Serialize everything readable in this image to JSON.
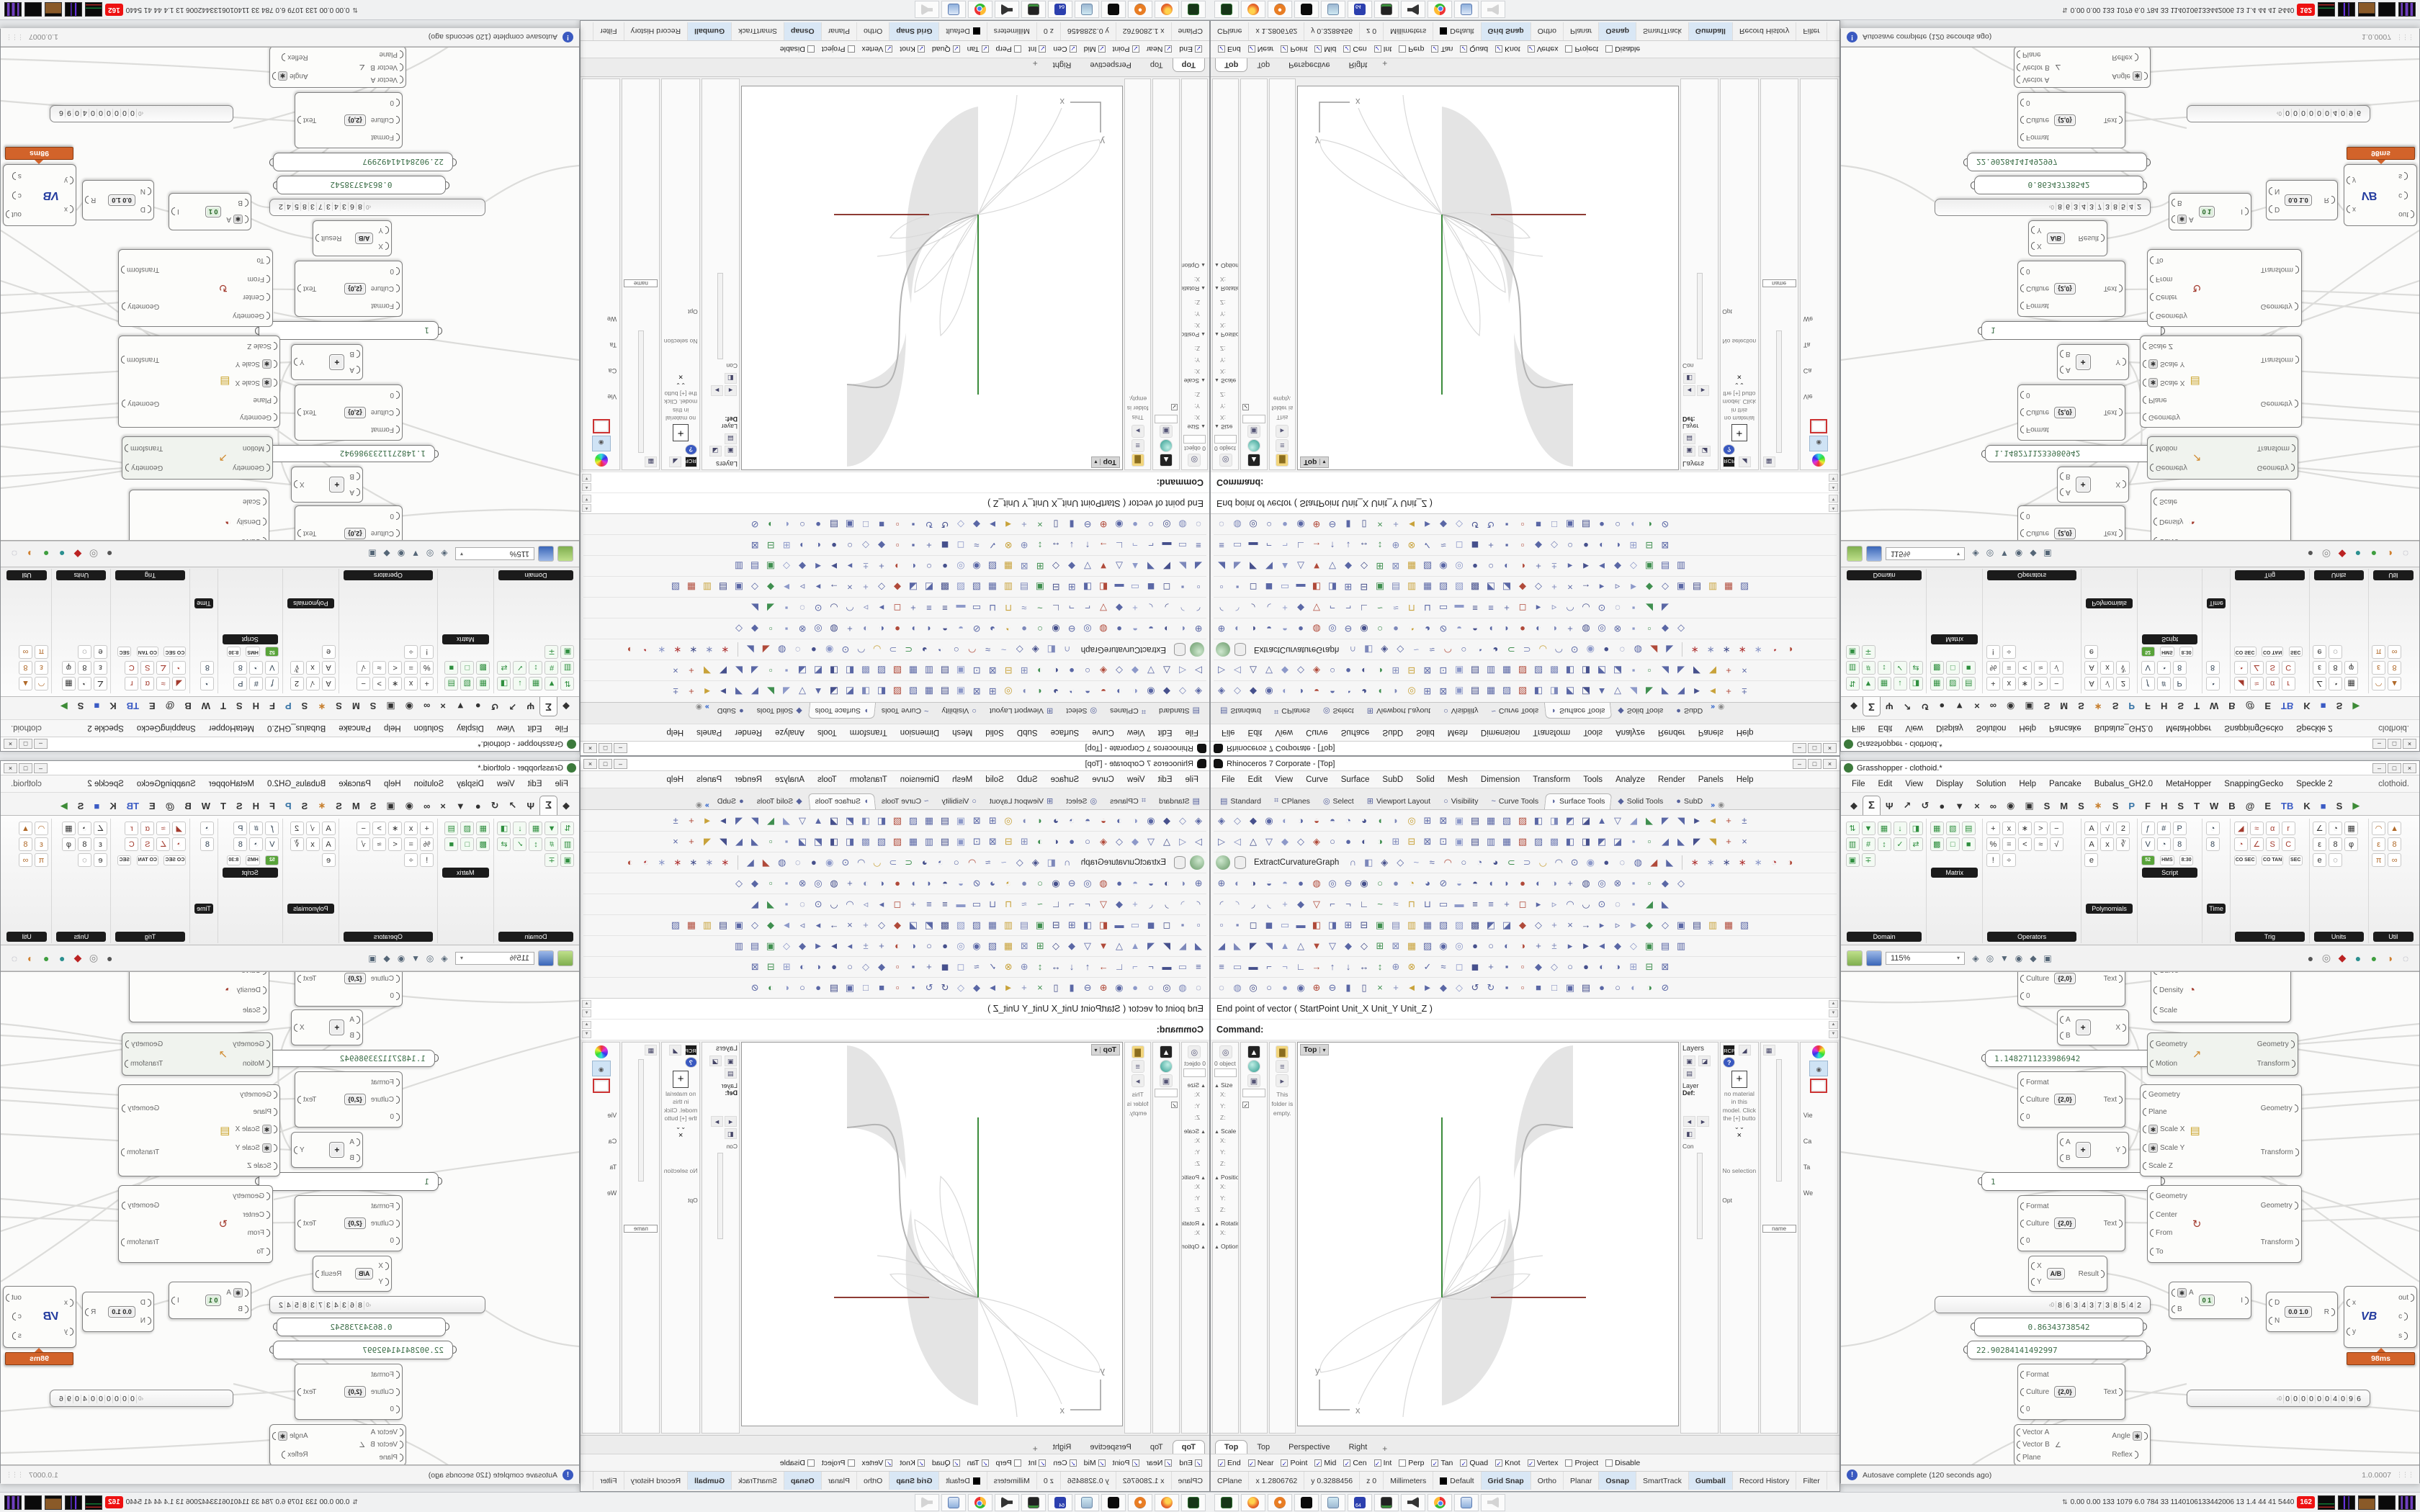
{
  "rhino": {
    "title": "Rhinoceros 7 Corporate - [Top]",
    "window_controls": [
      "–",
      "□",
      "×"
    ],
    "menu": [
      "File",
      "Edit",
      "View",
      "Curve",
      "Surface",
      "SubD",
      "Solid",
      "Mesh",
      "Dimension",
      "Transform",
      "Tools",
      "Analyze",
      "Render",
      "Panels",
      "Help"
    ],
    "tabs": [
      {
        "glyph": "▤",
        "label": "Standard"
      },
      {
        "glyph": "⌗",
        "label": "CPlanes"
      },
      {
        "glyph": "◎",
        "label": "Select"
      },
      {
        "glyph": "⊞",
        "label": "Viewport Layout"
      },
      {
        "glyph": "○",
        "label": "Visibility"
      },
      {
        "glyph": "~",
        "label": "Curve Tools"
      },
      {
        "glyph": "◗",
        "label": "Surface Tools",
        "active": true
      },
      {
        "glyph": "◆",
        "label": "Solid Tools"
      },
      {
        "glyph": "●",
        "label": "SubD"
      }
    ],
    "tabs_overflow": "»",
    "toolbar_label": "ExtractCurvatureGraph",
    "toolbar_rows": [
      "◈◇◆◉◐◑◒◓◔◕◖◗◎⊞⊠▣▤▦▧▨◧◨◩◪▲▽◢◣◤◥►◄+±",
      "▷◁△▽◆◇◈○●◐◑⊞⊟⊠⊡▣▤▥▦▧▨▩◧◨◩◪▪▫◢◣◤◥+×",
      "∩◧◈◇~≈◠○◔◕⊂⊃◡◠⊙◉●◌◍◢◣",
      "⊕◐◑◒◓●◍◎⊖◉○●◔◕⊘◒◓◖◗●◐◑+◍◎⊗▪▫◆◇",
      "◜◝◞◟+◆▽⌐¬∟~≈⊓⊔▭▬≡≡+◻▸▹◠◡⊙◌▪◢◣",
      "▫▪◻◼▭▬◧◨⊞⊟▣▤▥▦▧▨▩◩◪◆◇+×→▸▹►◆◇▣▤▥▦▧",
      "◢◣◤◥▲△▼▽◆◇⊞⊠▦▨◉◎●○◐◑+±▸►◄◆◇▣▤▥",
      "≡▭▬⌐¬∟→↑↓↔↕⊕⊗✓≈◻◼+▪▫◆◇○●◐◑⊞⊟⊠",
      "◌◍◎○●◉⊕⊖▮▯×+◄►◆◇↺↻▪▫■□▣▤●○◐◑⊘"
    ],
    "toolbar_axes": "∗∗∗∗∗◔◑",
    "history_line": "End point of vector ( StartPoint  Unit_X  Unit_Y  Unit_Z )",
    "command_prompt": "Command:",
    "left_panel": {
      "object_count": "0 object",
      "sections": [
        "Size",
        "Scale",
        "Position",
        "Rotation"
      ],
      "axes": [
        "X:",
        "Y:",
        "Z:"
      ],
      "options": "Options",
      "folder_note": "This folder is empty.",
      "check": "✓"
    },
    "viewport": {
      "title": "Top",
      "dropdown": "▾",
      "axis_labels": {
        "x": "x",
        "y": "y"
      },
      "tabs": [
        {
          "label": "Top",
          "active": true
        },
        {
          "label": "Top"
        },
        {
          "label": "Perspective"
        },
        {
          "label": "Right"
        }
      ],
      "add_tab": "+"
    },
    "right_panel": {
      "layers_title": "Layers",
      "layer_label": "Layer",
      "layer_value": "Def:",
      "rcp": "RCP",
      "help": "?",
      "plus": "+",
      "no_material": "no material in this model. Click the [+] butto",
      "close": "×",
      "chevrons": "⌄⌄",
      "no_selection": "No selection",
      "misc1": "Con",
      "misc2": "Opt",
      "name_box": "name",
      "side_labels": [
        "Vie",
        "Ca",
        "Ta",
        "We"
      ]
    },
    "osnap": [
      {
        "label": "End",
        "checked": true
      },
      {
        "label": "Near",
        "checked": true
      },
      {
        "label": "Point",
        "checked": true
      },
      {
        "label": "Mid",
        "checked": true
      },
      {
        "label": "Cen",
        "checked": true
      },
      {
        "label": "Int",
        "checked": true
      },
      {
        "label": "Perp",
        "checked": false
      },
      {
        "label": "Tan",
        "checked": true
      },
      {
        "label": "Quad",
        "checked": true
      },
      {
        "label": "Knot",
        "checked": true
      },
      {
        "label": "Vertex",
        "checked": true
      },
      {
        "label": "Project",
        "checked": false
      },
      {
        "label": "Disable",
        "checked": false
      }
    ],
    "status": [
      {
        "label": "CPlane"
      },
      {
        "label": "x 1.2806762"
      },
      {
        "label": "y 0.3288456"
      },
      {
        "label": "z 0"
      },
      {
        "label": "Millimeters"
      },
      {
        "label": "Default",
        "swatch": true
      },
      {
        "label": "Grid Snap",
        "on": true
      },
      {
        "label": "Ortho"
      },
      {
        "label": "Planar"
      },
      {
        "label": "Osnap",
        "on": true
      },
      {
        "label": "SmartTrack"
      },
      {
        "label": "Gumball",
        "on": true
      },
      {
        "label": "Record History"
      },
      {
        "label": "Filter"
      }
    ]
  },
  "gh": {
    "title": "Grasshopper - clothoid.*",
    "menu": [
      "File",
      "Edit",
      "View",
      "Display",
      "Solution",
      "Help",
      "Pancake",
      "Bubalus_GH2.0",
      "MetaHopper",
      "SnappingGecko",
      "Speckle 2"
    ],
    "doc_label": "clothoid.",
    "tabs": [
      {
        "g": "◆"
      },
      {
        "g": "Σ",
        "active": true
      },
      {
        "g": "Ψ"
      },
      {
        "g": "↗"
      },
      {
        "g": "↺"
      },
      {
        "g": "●"
      },
      {
        "g": "▼"
      },
      {
        "g": "×"
      },
      {
        "g": "∞"
      },
      {
        "g": "◉"
      },
      {
        "g": "▣"
      },
      {
        "g": "S"
      },
      {
        "g": "M"
      },
      {
        "g": "S"
      },
      {
        "g": "∗",
        "c": "org"
      },
      {
        "g": "S"
      },
      {
        "g": "P",
        "c": "py"
      },
      {
        "g": "F"
      },
      {
        "g": "H"
      },
      {
        "g": "S"
      },
      {
        "g": "T"
      },
      {
        "g": "W"
      },
      {
        "g": "B"
      },
      {
        "g": "@"
      },
      {
        "g": "E"
      },
      {
        "g": "TB",
        "c": "blu"
      },
      {
        "g": "K"
      },
      {
        "g": "■",
        "c": "blu"
      },
      {
        "g": "S"
      },
      {
        "g": "▶",
        "c": "grn"
      }
    ],
    "ribbon": {
      "groups": [
        {
          "label": "Domain",
          "icons": "⇅▼▦↓◨▥#↕✓⇄▣∓"
        },
        {
          "label": "Matrix",
          "icons": "▦▧▤▩□■"
        },
        {
          "label": "Operators",
          "icons": "+x∗>−%=<≈√!÷"
        },
        {
          "label": "Polynomials",
          "icons": "A√2Ax∛e"
        },
        {
          "label": "Script",
          "icons": "ƒ#PV◔8"
        },
        {
          "label": "Time",
          "icons": "◔8"
        },
        {
          "label": "Trig",
          "icons": "◢≈αr◔∠SC"
        },
        {
          "label": "Units",
          "icons": "∠◔▦ε8φe◌"
        },
        {
          "label": "Util",
          "icons": "◠▲ε8π∞"
        }
      ],
      "badges": {
        "yom": "52",
        "hms": "HMS",
        "clock": "8:30",
        "co_sec": "CO SEC",
        "co_tan": "CO TAN",
        "sec": "SEC"
      }
    },
    "toolbar": {
      "zoom": "115%",
      "left_icons": "◈◎▼◉◆▣",
      "right_icons": "●◎◆●●◑◌"
    },
    "status_text": "Autosave complete (120 seconds ago)",
    "version": "1.0.0007",
    "lbl": {
      "geometry": "Geometry",
      "transform": "Transform",
      "plane": "Plane",
      "center": "Center",
      "from": "From",
      "to": "To",
      "motion": "Motion",
      "curve": "Curve",
      "density": "Density",
      "scale": "Scale",
      "scale_x": "Scale X",
      "scale_y": "Scale Y",
      "scale_z": "Scale Z",
      "format": "Format",
      "culture": "Culture",
      "culture_v": "{2,0}",
      "text": "Text",
      "zero": "0",
      "a": "A",
      "b": "B",
      "xu": "X",
      "yu": "Y",
      "xl": "x",
      "yl": "y",
      "i": "I",
      "d": "D",
      "n": "N",
      "r": "R",
      "out": "out",
      "c": "c",
      "s": "s",
      "result": "Result",
      "vector_a": "Vector A",
      "vector_b": "Vector B",
      "angle": "Angle",
      "reflex": "Reflex",
      "add_core": "+",
      "div_core": "A/B",
      "gate_core": "0 1",
      "remap_core": "0.0 1.0",
      "vb_core": "VB",
      "star": "✱"
    },
    "values": {
      "slider1": "1.1482711233986942",
      "panel_one": "1",
      "digits_lead": "‹0",
      "digits1": "86343738542",
      "digits2": "0000004096",
      "panel_a": "0.86343738542",
      "panel_b": "22.90284141492997",
      "time_badge": "98ms"
    }
  },
  "taskbar": {
    "icon_names": [
      "obs",
      "firefox",
      "blender",
      "rhino",
      "notepad",
      "floppy-64",
      "display",
      "speaker",
      "chrome",
      "scroll",
      "speaker-muted"
    ],
    "monitor": {
      "chevron": "⇅",
      "text": "0.00 0.00  133 1079  6.0  784  33  1140106133442006  13  1.4  44  41  5440",
      "alert": "162"
    }
  }
}
